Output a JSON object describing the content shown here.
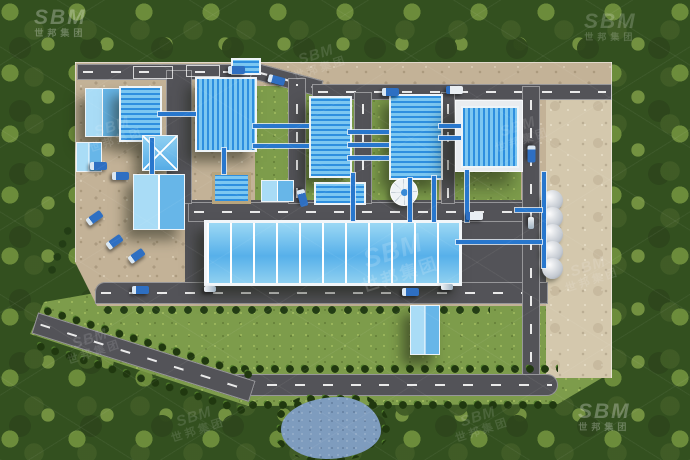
{
  "scene": {
    "description": "Aerial 3D rendering of a blue-roofed industrial aggregate / sand processing plant compound surrounded by dense forest, with internal asphalt roads, conveyor bridges, a long multi-bay storage warehouse, white storage silos, a thickener tank, a dirt stockyard, tree-lined perimeter boulevard and a pond",
    "long_warehouse_bay_count": 11,
    "silo_count": 5
  },
  "watermark": {
    "logo": "SBM",
    "cn": "世邦集团"
  },
  "palette": {
    "forest": "#33501f",
    "lawn": "#7d9c4b",
    "dirt": "#c3b297",
    "stockyard": "#d4c8ad",
    "road": "#535358",
    "roof_dark": "#2e8fdf",
    "roof_light": "#7cc7f1",
    "roof_pale": "#a9dcf6",
    "trim": "#eef4f8",
    "conveyor": "#2877cd",
    "water": "#7e9cbe"
  }
}
